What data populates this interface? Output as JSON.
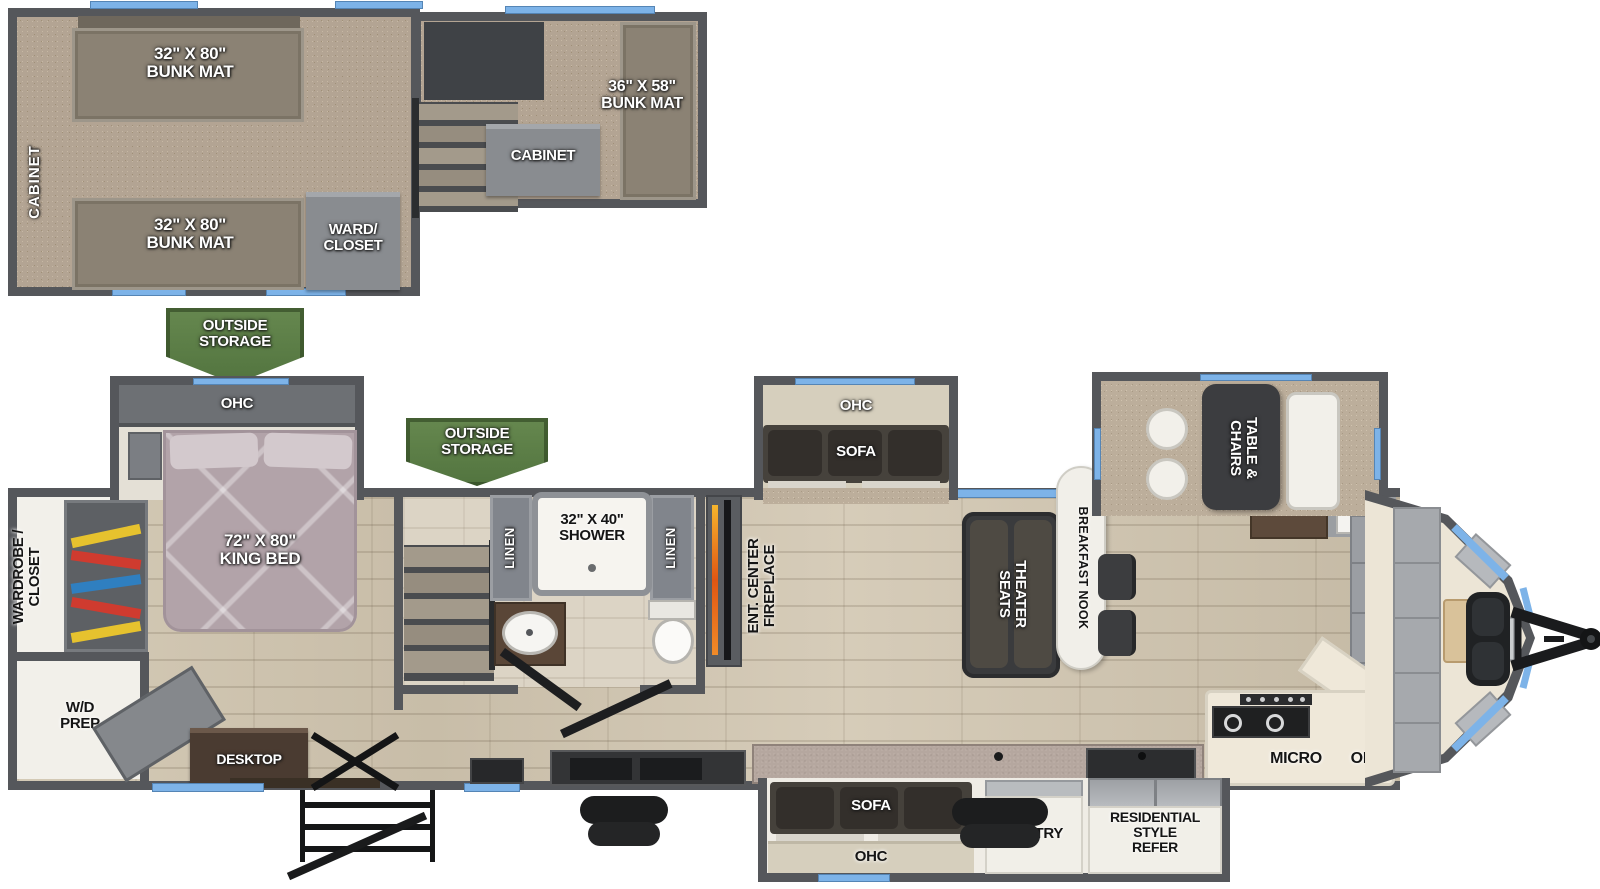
{
  "colors": {
    "wall": "#55575b",
    "window_accent": "#7db3e8",
    "banner_green": "#5c7e4a",
    "carpet": "#b3a493",
    "wood_floor": "#cfc5b1",
    "furniture_dark": "#3c3d3f",
    "bed": "#b2a3a9"
  },
  "loft": {
    "cabinet_side_label": "CABINET",
    "bunk_mat_32": "32\" X 80\"\nBUNK MAT",
    "ward_closet": "WARD/\nCLOSET",
    "cabinet_box": "CABINET",
    "bunk_mat_right": "36\" X 58\"\nBUNK MAT"
  },
  "banners": {
    "outside_storage": "OUTSIDE\nSTORAGE"
  },
  "bedroom": {
    "ohc": "OHC",
    "king_bed": "72\" X 80\"\nKING BED",
    "wardrobe_closet": "WARDROBE /\nCLOSET",
    "wd_prep": "W/D\nPREP",
    "desktop": "DESKTOP"
  },
  "bathroom": {
    "linen": "LINEN",
    "shower": "32\" X 40\"\nSHOWER"
  },
  "living": {
    "fireplace": "ENT. CENTER\nFIREPLACE",
    "slide_ohc": "OHC",
    "slide_sofa": "SOFA",
    "theater_seats": "THEATER\nSEATS",
    "breakfast_nook": "BREAKFAST NOOK"
  },
  "dinette": {
    "table_chairs": "TABLE &\nCHAIRS"
  },
  "kitchen": {
    "micro": "MICRO",
    "ohc": "OHC"
  },
  "rear_slide": {
    "sofa": "SOFA",
    "ohc": "OHC",
    "pantry": "PANTRY",
    "refer": "RESIDENTIAL\nSTYLE\nREFER"
  }
}
